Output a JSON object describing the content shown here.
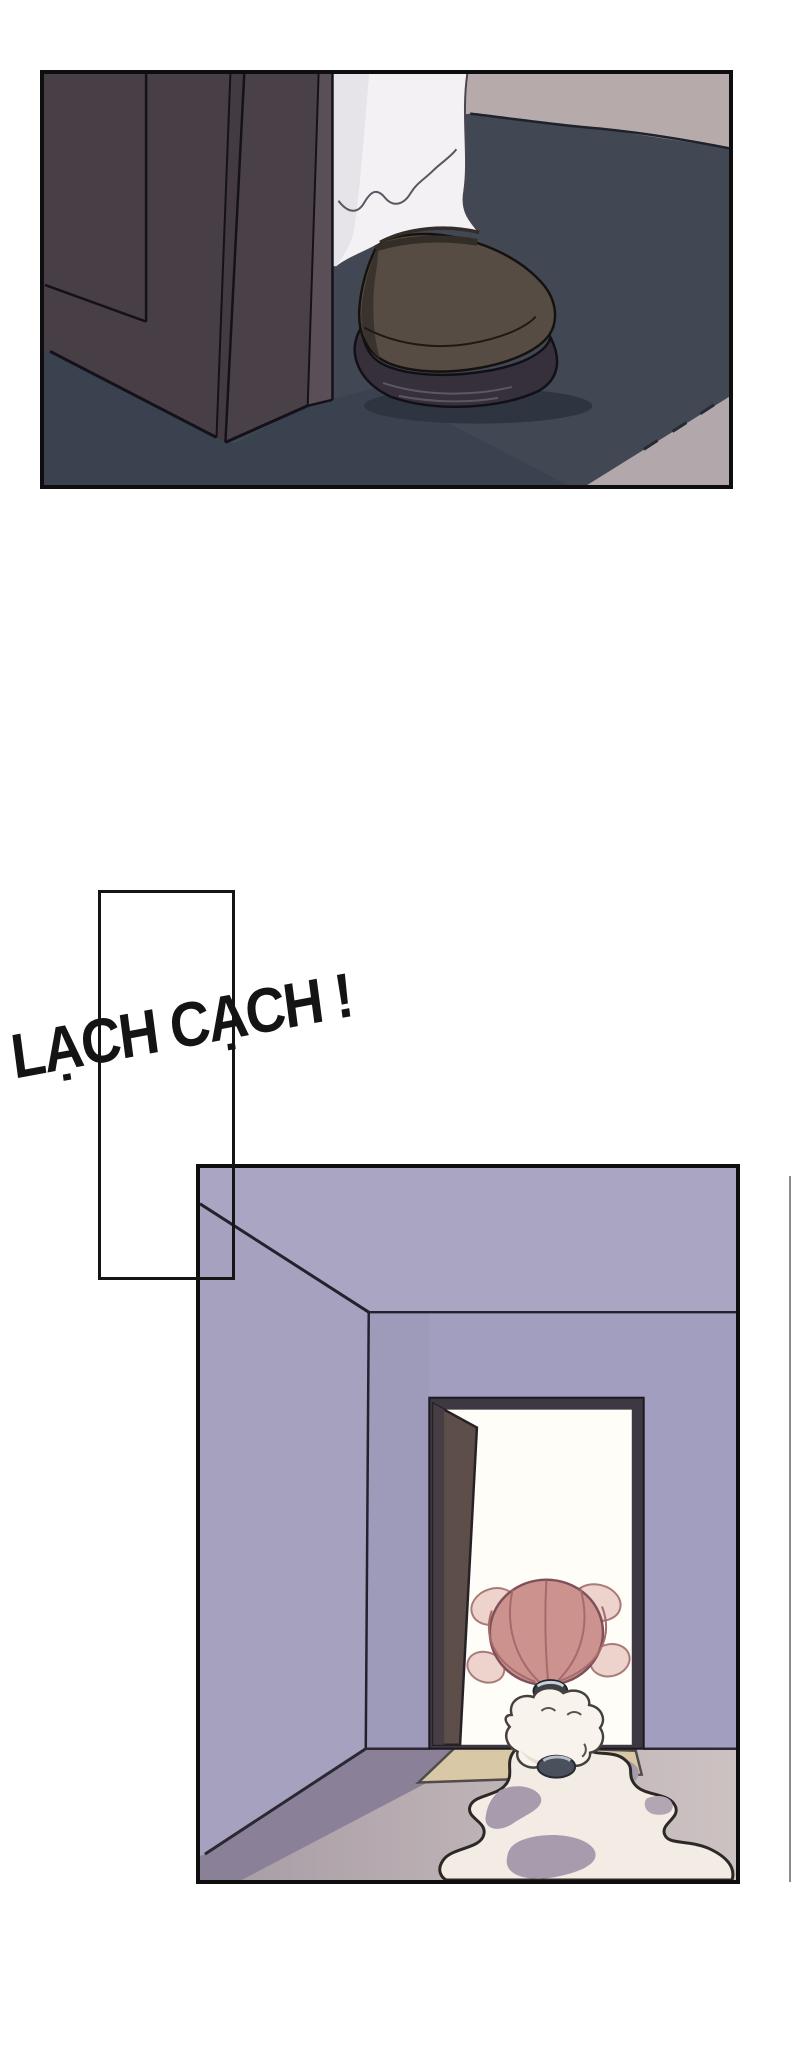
{
  "sfx": {
    "text": "LẠCH CẠCH !",
    "color": "#141414"
  },
  "scene": {
    "panel1_description": "close-up of a dark shoe and white pant leg stepping past a dark wooden door onto a dark mat",
    "panel2_description": "lavender room, open door with bright doorway, small pink-haired character melting into a puddle that flows toward the viewer"
  },
  "palette": {
    "page_background": "#ffffff",
    "panel_border": "#0e0e0e",
    "p1_background": "#b6abaa",
    "p1_floor": "#414854",
    "p1_floor_dark": "#3a4250",
    "p1_floor_corner_light": "#b2a8ab",
    "p1_door": "#483e46",
    "p1_door_edge": "#5a4f57",
    "p1_pant": "#f3f1f4",
    "p1_shoe_upper": "#564c43",
    "p1_shoe_sole": "#35303a",
    "p2_ceiling": "#a9a5c2",
    "p2_back_wall": "#a29ec0",
    "p2_side_wall": "#a5a1bf",
    "p2_floor_shadow": "#8a8098",
    "p2_mat": "#d8c8a6",
    "p2_door_frame": "#3d3841",
    "p2_open_door": "#5d4e4a",
    "p2_doorway_light": "#fffdf8",
    "p2_hair": "#cb928e",
    "p2_hair_tuft": "#eed3cc",
    "p2_cloud_body": "#f8f3ec",
    "p2_puddle": "#f2ece4",
    "p2_puddle_shadow": "#a89bad"
  }
}
